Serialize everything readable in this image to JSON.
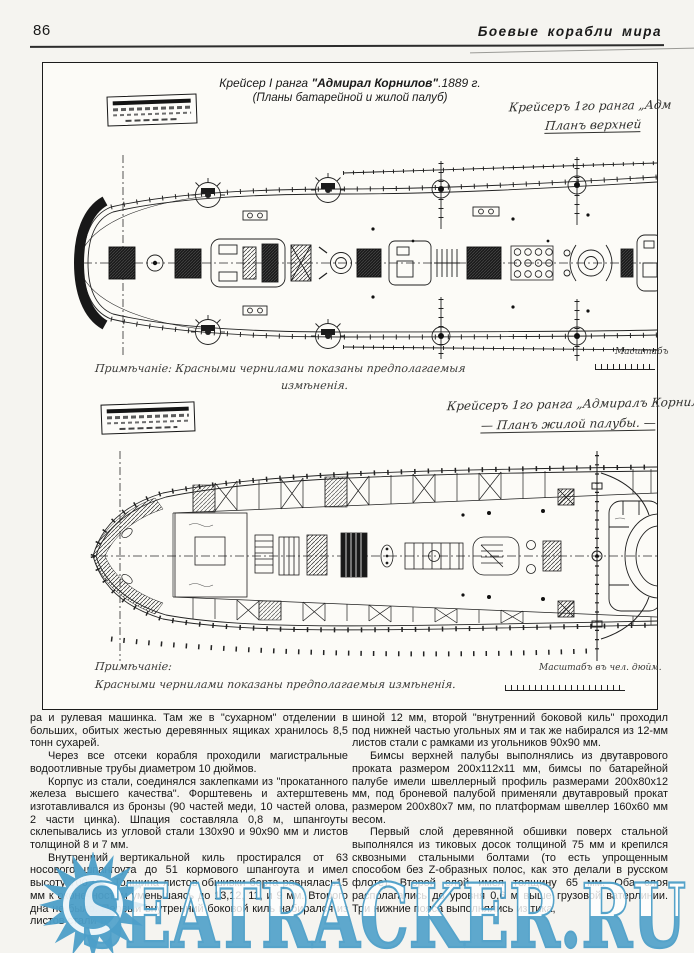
{
  "page": {
    "number": "86",
    "running_title": "Боевые корабли мира"
  },
  "figure": {
    "title": {
      "prefix": "Крейсер I ранга ",
      "ship": "\"Адмирал Корнилов\"",
      "suffix": ".1889 г.",
      "subtitle": "(Планы батарейной и жилой палуб)"
    },
    "plan1": {
      "handwritten_line1": "Крейсеръ 1го ранга „Адм",
      "handwritten_line2": "Планъ верхней",
      "note_line1": "Примѣчаніе: Красными чернилами показаны предполагаемыя",
      "note_line2": "измѣненія.",
      "scale_label": "Масштабъ"
    },
    "plan2": {
      "handwritten_line1": "Крейсеръ 1го ранга „Адмиралъ Корнил",
      "handwritten_line2": "— Планъ жилой палубы. —",
      "note_line1": "Примѣчаніе:",
      "note_line2": "Красными чернилами показаны предполагаемыя измѣненія.",
      "scale_label": "Масштабъ въ чел. дюйм."
    }
  },
  "article": {
    "left_column": [
      "ра и рулевая машинка. Там же в \"сухарном\" отделении в больших, обитых жестью деревянных ящиках хранилось 8,5 тонн сухарей.",
      "Через все отсеки корабля проходили магистральные водоотливные трубы диаметром 10 дюймов.",
      "Корпус из стали, соединялся заклепками из \"прокатанного железа высшего качества\". Форштевень и ахтерштевень изготавливался из бронзы (90 частей меди, 10 частей олова, 2 части цинка). Шпация составляла 0,8 м, шпангоуты склепывались из угловой стали 130х90 и 90х90 мм и листов толщиной 8 и 7 мм.",
      "Внутренний вертикальной киль простирался от 63 носового шпангоута до 51 кормового шпангоута и имел высоту 700 мм. Толщина листов обшивки борта равнялась15 мм к оконечностям уменьшаясь до 13,12, 11, и 9 мм. Второго дна не было. Первый внутренний боковой киль набирался из листов стали тол-"
    ],
    "right_column": [
      "шиной 12 мм, второй \"внутренний боковой киль\" проходил под нижней частью угольных ям и так же набирался из 12-мм листов стали с рамками из угольников 90х90 мм.",
      "Бимсы верхней палубы выполнялись из двутаврового проката размером 200х112х11 мм, бимсы по батарейной палубе имели швеллерный профиль размерами 200х80х12 мм, под броневой палубой применяли двутавровый прокат размером 200х80х7 мм, по платформам швеллер 160х60 мм весом.",
      "Первый слой деревянной обшивки поверх стальной выполнялся из тиковых досок толщиной 75 мм и крепился сквозными стальными болтами (то есть упрощенным способом без Z-образных полос, как это делали в русском флоте). Второй слой имел толщину 65 мм. Оба слоя располагались до уровня 0,6 м выше грузовой ватерлинии. Три нижние пояса выполнялись из тика,"
    ]
  },
  "watermark": {
    "text": "SEATRACKER.RU",
    "color": "#4d9fc9"
  }
}
